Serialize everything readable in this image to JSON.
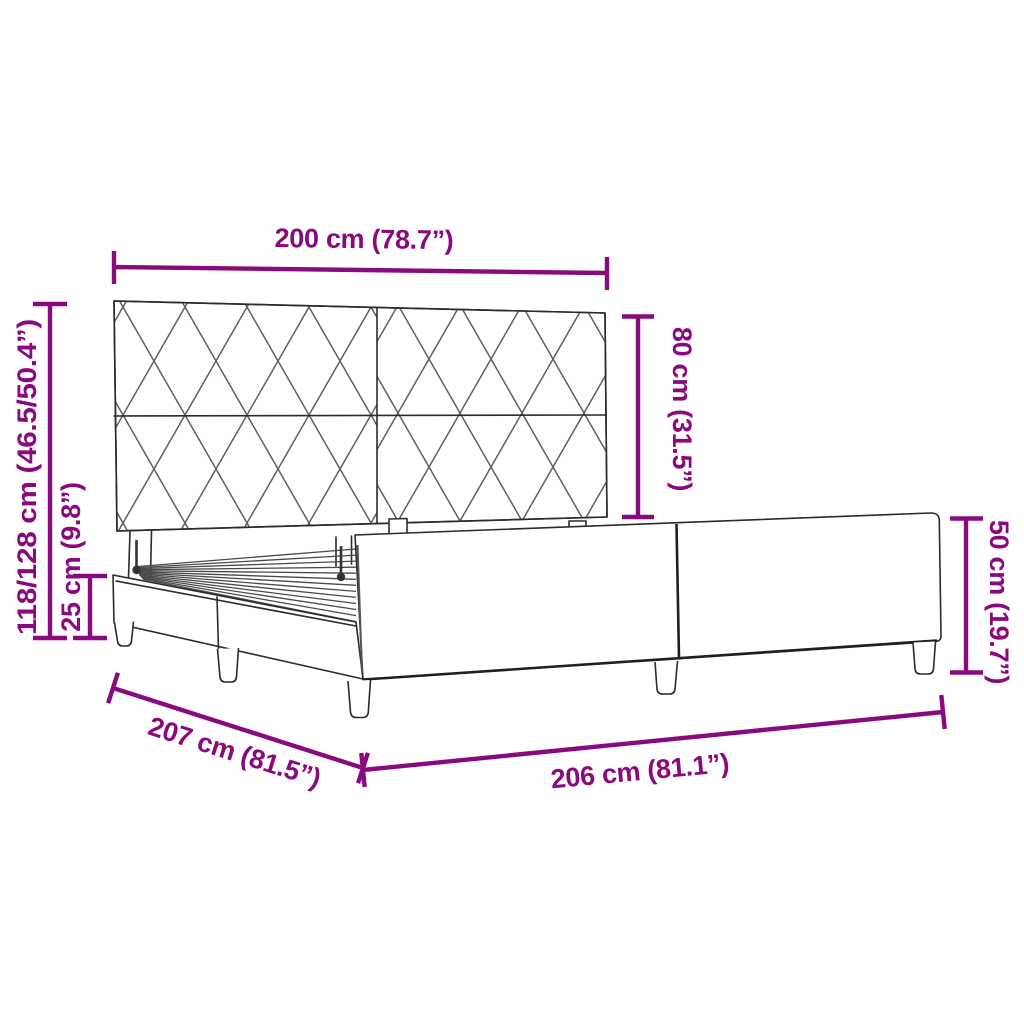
{
  "figure": {
    "kind": "product-dimension-diagram",
    "subject": "upholstered bed frame with diamond-pattern headboard",
    "background": "#FFFFFF",
    "colors": {
      "dimension": "#8A0A7D",
      "outline": "#2B2B2B",
      "pattern_line": "#5F5F5F"
    },
    "dimensions": [
      {
        "id": "headboard-width",
        "label": "200 cm (78.7”)"
      },
      {
        "id": "headboard-height",
        "label": "80 cm (31.5”)"
      },
      {
        "id": "total-height",
        "label": "118/128 cm (46.5/50.4”)"
      },
      {
        "id": "base-height",
        "label": "25 cm (9.8”)"
      },
      {
        "id": "frame-depth",
        "label": "207 cm (81.5”)"
      },
      {
        "id": "frame-length",
        "label": "206 cm (81.1”)"
      },
      {
        "id": "side-rail-height",
        "label": "50 cm (19.7”)"
      }
    ]
  }
}
